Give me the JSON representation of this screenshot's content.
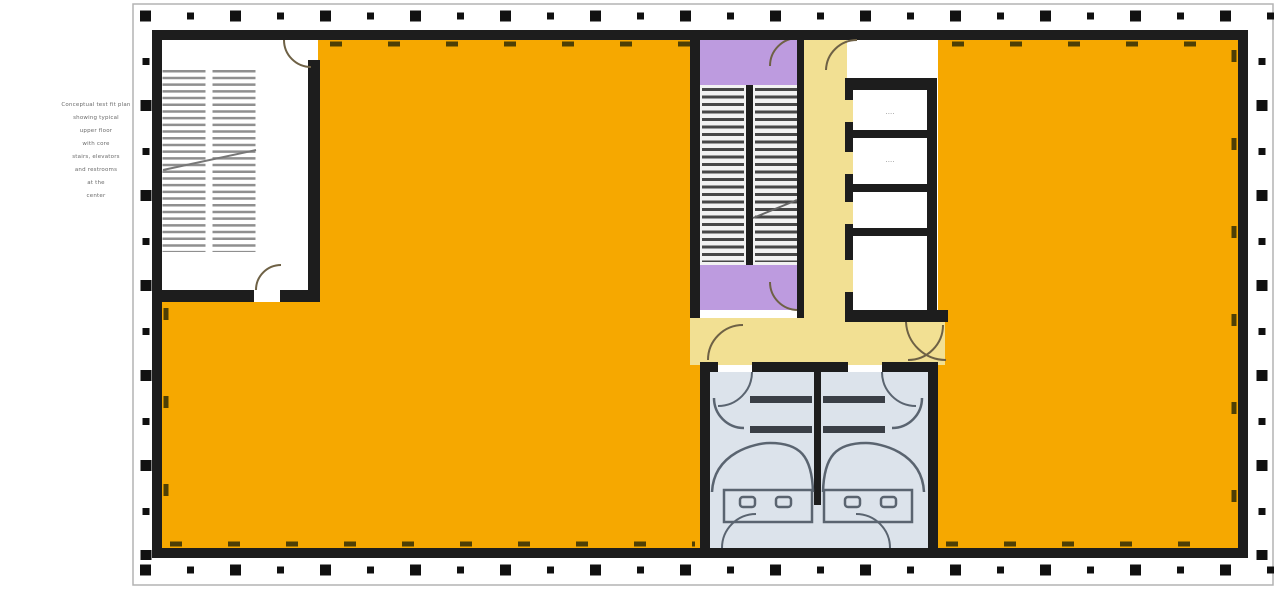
{
  "plan": {
    "type": "office-floor-plan",
    "annotation": {
      "lines": [
        "Conceptual test fit plan",
        "showing typical",
        "upper floor",
        "with core",
        "stairs, elevators",
        "and restrooms",
        "at the",
        "center"
      ]
    },
    "service_rooms": {
      "labels": [
        "....",
        "...."
      ]
    },
    "colors": {
      "office_orange": "#F6A800",
      "corridor_cream": "#F2E093",
      "stair_purple": "#BD9BDF",
      "restroom_blue": "#DCE3EB",
      "stair_white": "#F2F2F2",
      "wall_dark": "#1d1d1d"
    }
  }
}
